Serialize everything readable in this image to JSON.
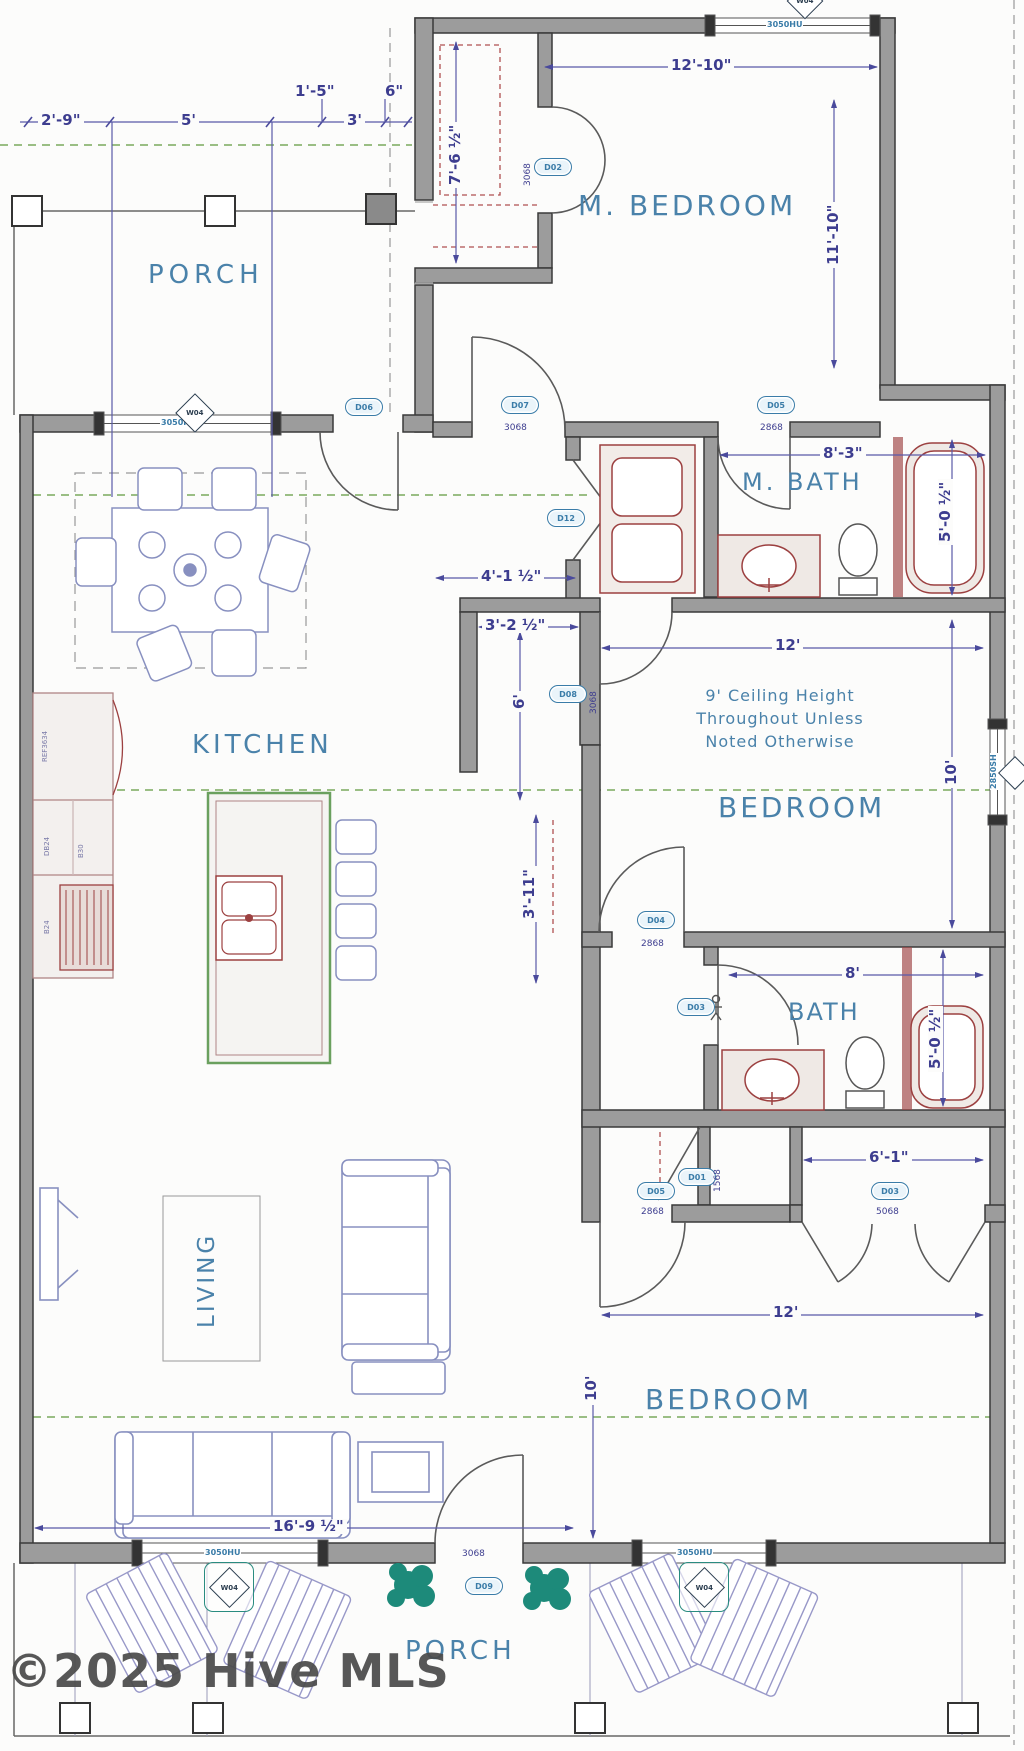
{
  "watermark": "©2025 Hive MLS",
  "rooms": {
    "porch_top": "PORCH",
    "m_bedroom": "M. BEDROOM",
    "m_bath": "M. BATH",
    "kitchen": "KITCHEN",
    "bedroom_mid": "BEDROOM",
    "bath": "BATH",
    "living": "LIVING",
    "bedroom_bottom": "BEDROOM",
    "porch_bottom": "PORCH"
  },
  "note": {
    "line1": "9' Ceiling Height",
    "line2": "Throughout Unless",
    "line3": "Noted Otherwise"
  },
  "dims": {
    "porch_1": "2'-9\"",
    "porch_2": "5'",
    "porch_3": "1'-5\"",
    "porch_4": "3'",
    "porch_5": "6\"",
    "mbr_w": "12'-10\"",
    "mbr_h": "11'-10\"",
    "mbr_closet": "7'-6 ½\"",
    "mbath_w": "8'-3\"",
    "mbath_h": "5'-0 ½\"",
    "foyer_w": "4'-1 ½\"",
    "hall_w": "3'-2 ½\"",
    "hall_l": "6'",
    "hall_l2": "3'-11\"",
    "bed_mid_w": "12'",
    "bed_mid_h": "10'",
    "bath_w": "8'",
    "bath_h": "5'-0 ½\"",
    "closet_w": "6'-1\"",
    "bed_bot_w": "12'",
    "bed_bot_h": "10'",
    "living_w": "16'-9 ½\""
  },
  "doors": {
    "entry": {
      "label": "D06"
    },
    "mbr": {
      "label": "D07",
      "size": "3068"
    },
    "mbr_closet": {
      "label": "D02",
      "size": "3068"
    },
    "mbath": {
      "label": "D05",
      "size": "2868"
    },
    "laundry": {
      "label": "D12"
    },
    "hall_bed": {
      "label": "D08",
      "size": "3068"
    },
    "bed_mid": {
      "label": "D04",
      "size": "2868"
    },
    "bath": {
      "label": "D03"
    },
    "linen": {
      "label": "D01",
      "size": "1568"
    },
    "bed_bot": {
      "label": "D05",
      "size": "2868"
    },
    "bot_closet": {
      "label": "D03",
      "size": "5068"
    },
    "porch": {
      "label": "D09",
      "size": "3068"
    }
  },
  "windows": {
    "mbr": {
      "size": "3050HU",
      "tag": "W04"
    },
    "kitchen": {
      "size": "3050HU",
      "tag": "W04"
    },
    "bed_mid": {
      "size": "2850SH"
    },
    "living": {
      "size": "3050HU",
      "tag": "W04"
    },
    "bed_bot": {
      "size": "3050HU",
      "tag": "W04"
    }
  },
  "cabinets": {
    "c1": "REF3634",
    "c2": "DB24",
    "c3": "B30",
    "c4": "B24"
  }
}
